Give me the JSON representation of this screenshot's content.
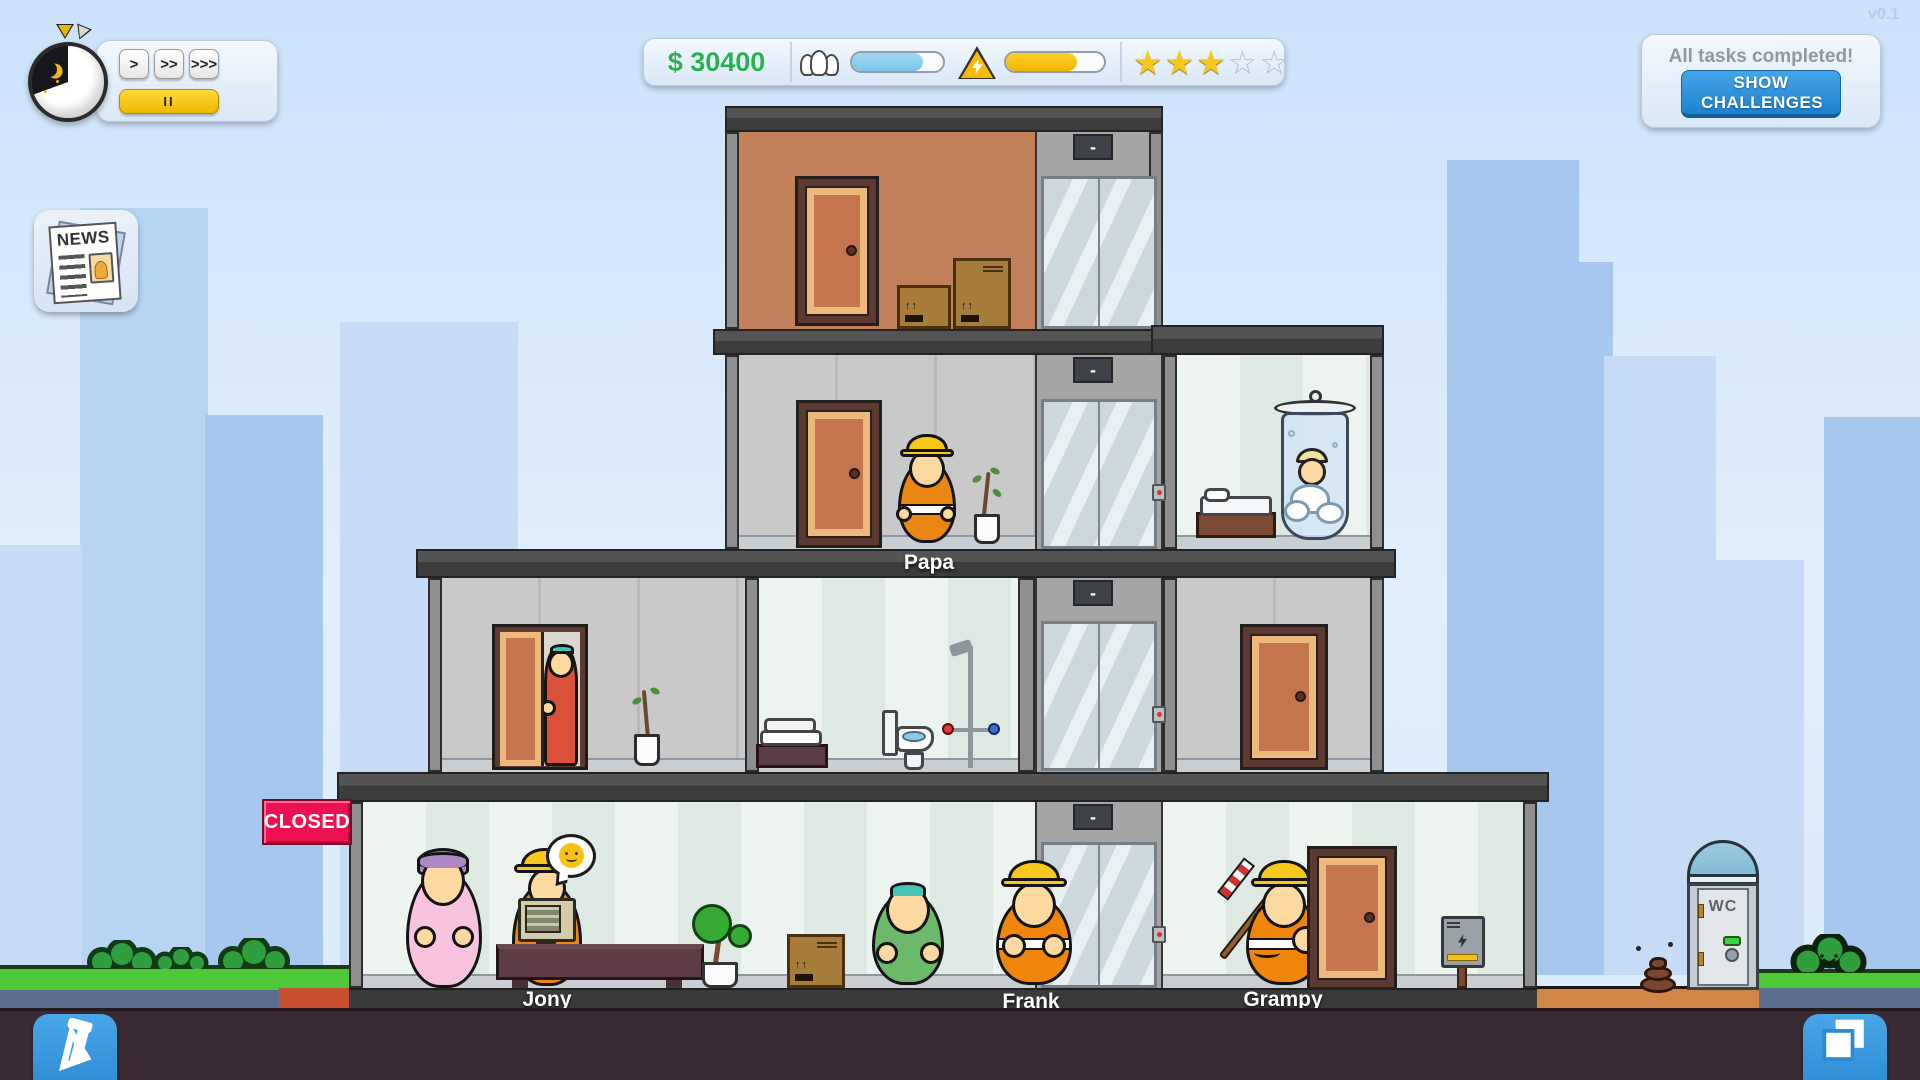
{
  "version": "v0.1",
  "hud": {
    "speed_1": ">",
    "speed_2": ">>",
    "speed_3": ">>>",
    "pause": "II",
    "money": "$ 30400",
    "population_fill_pct": 78,
    "energy_fill_pct": 72,
    "stars_filled": "★★★",
    "stars_empty": "☆☆",
    "tasks_status": "All tasks completed!",
    "tasks_button": "SHOW CHALLENGES"
  },
  "news": {
    "label": "NEWS"
  },
  "building": {
    "closed_sign": "CLOSED",
    "elevator_display": "-",
    "characters": {
      "floor3": "Papa",
      "lobby_receptionist": "Jony",
      "lobby_worker": "Frank",
      "lobby_janitor": "Grampy"
    }
  },
  "outdoor": {
    "wc_label": "WC"
  }
}
